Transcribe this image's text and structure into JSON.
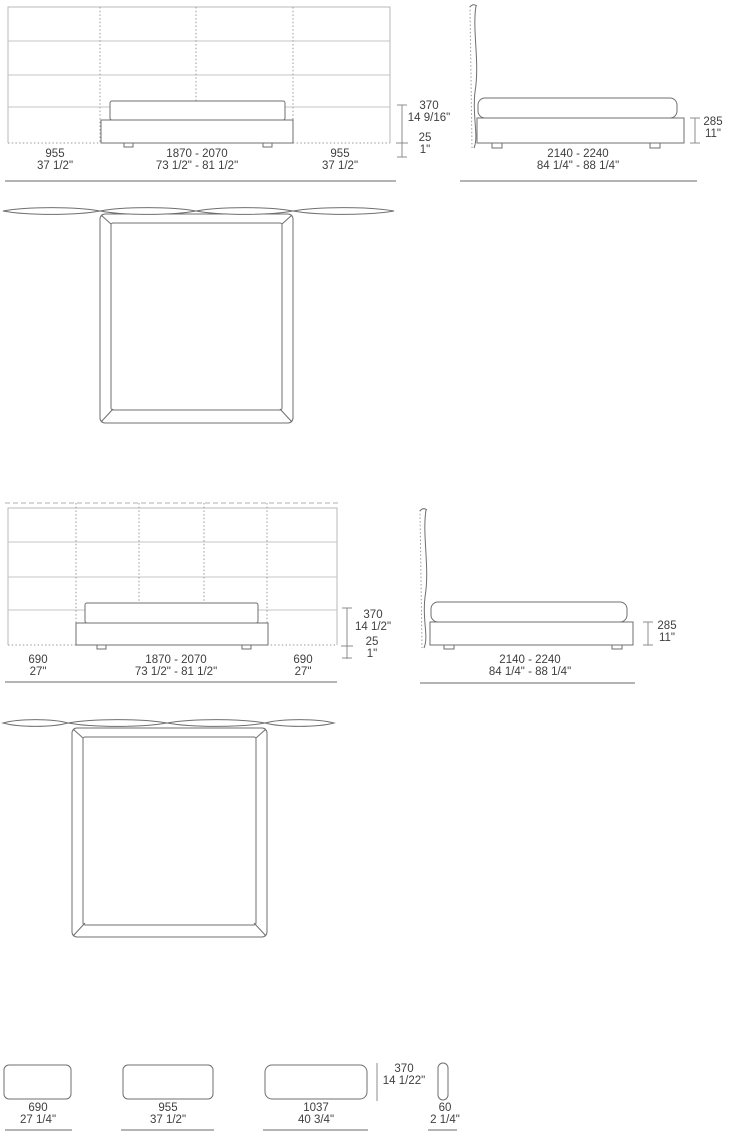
{
  "colors": {
    "background": "#ffffff",
    "line_light": "#b8b8b8",
    "line_dark": "#6f6f6f",
    "line_dotted": "#9a9a9a",
    "ground_line": "#9b9b9b",
    "text": "#3e3e3e"
  },
  "views": {
    "front_wide": {
      "left": {
        "mm": "955",
        "inch": "37 1/2\""
      },
      "center": {
        "mm": "1870 - 2070",
        "inch": "73 1/2\" - 81 1/2\""
      },
      "right": {
        "mm": "955",
        "inch": "37 1/2\""
      },
      "height": {
        "mm": "370",
        "inch": "14 9/16\""
      },
      "clearance": {
        "mm": "25",
        "inch": "1\""
      }
    },
    "side_wide": {
      "length": {
        "mm": "2140 - 2240",
        "inch": "84 1/4\" - 88 1/4\""
      },
      "base_height": {
        "mm": "285",
        "inch": "11\""
      }
    },
    "front_narrow": {
      "left": {
        "mm": "690",
        "inch": "27\""
      },
      "center": {
        "mm": "1870 - 2070",
        "inch": "73 1/2\" - 81 1/2\""
      },
      "right": {
        "mm": "690",
        "inch": "27\""
      },
      "height": {
        "mm": "370",
        "inch": "14 1/2\""
      },
      "clearance": {
        "mm": "25",
        "inch": "1\""
      }
    },
    "side_narrow": {
      "length": {
        "mm": "2140 - 2240",
        "inch": "84 1/4\" - 88 1/4\""
      },
      "base_height": {
        "mm": "285",
        "inch": "11\""
      }
    },
    "headboard_panels": {
      "small": {
        "mm": "690",
        "inch": "27 1/4\""
      },
      "medium": {
        "mm": "955",
        "inch": "37 1/2\""
      },
      "large": {
        "mm": "1037",
        "inch": "40 3/4\""
      },
      "height": {
        "mm": "370",
        "inch": "14 1/22\""
      },
      "thickness": {
        "mm": "60",
        "inch": "2 1/4\""
      }
    }
  }
}
